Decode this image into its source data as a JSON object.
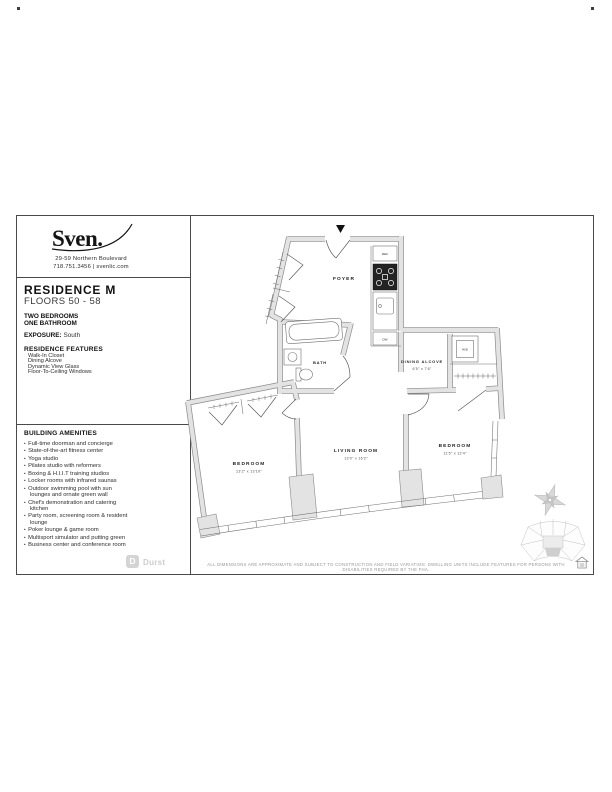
{
  "page": {
    "brand": {
      "logo_text": "Sven.",
      "address1": "29-59 Northern Boulevard",
      "address2": "718.751.3456 | svenlic.com"
    },
    "residence": {
      "title": "RESIDENCE M",
      "floors": "FLOORS 50 - 58",
      "beds": "TWO BEDROOMS",
      "baths": "ONE BATHROOM",
      "exposure_label": "EXPOSURE:",
      "exposure_value": "South"
    },
    "features": {
      "heading": "RESIDENCE FEATURES",
      "items": [
        "Walk-In Closet",
        "Dining Alcove",
        "Dynamic View Glass",
        "Floor-To-Ceiling Windows"
      ]
    },
    "amenities": {
      "heading": "BUILDING AMENITIES",
      "items": [
        "Full-time doorman and concierge",
        "State-of-the-art fitness center",
        "Yoga studio",
        "Pilates studio with reformers",
        "Boxing & H.I.I.T training studios",
        "Locker rooms with infrared saunas",
        "Outdoor swimming pool with sun lounges and ornate green wall",
        "Chef's demonstration and catering kitchen",
        "Party room, screening room & resident lounge",
        "Poker lounge & game room",
        "Multisport simulator and putting green",
        "Business center and conference room"
      ]
    },
    "plan": {
      "foyer": "FOYER",
      "bath": "BATH",
      "dining": "DINING ALCOVE",
      "dining_dims": "6'5\" x 7'6\"",
      "living": "LIVING ROOM",
      "living_dims": "13'0\" x 16'2\"",
      "bedroom1": "BEDROOM",
      "bedroom1_dims": "13'2\" x 13'10\"",
      "bedroom2": "BEDROOM",
      "bedroom2_dims": "11'5\" x 12'4\"",
      "ref": "REF",
      "dw": "DW",
      "wd": "W/D"
    },
    "footer": {
      "durst_initial": "D",
      "durst_name": "Durst",
      "disclaimer": "ALL DIMENSIONS ARE APPROXIMATE AND SUBJECT TO CONSTRUCTION AND FIELD VARIATION. DWELLING UNITS INCLUDE FEATURES FOR PERSONS WITH DISABILITIES REQUIRED BY THE FHA."
    }
  }
}
